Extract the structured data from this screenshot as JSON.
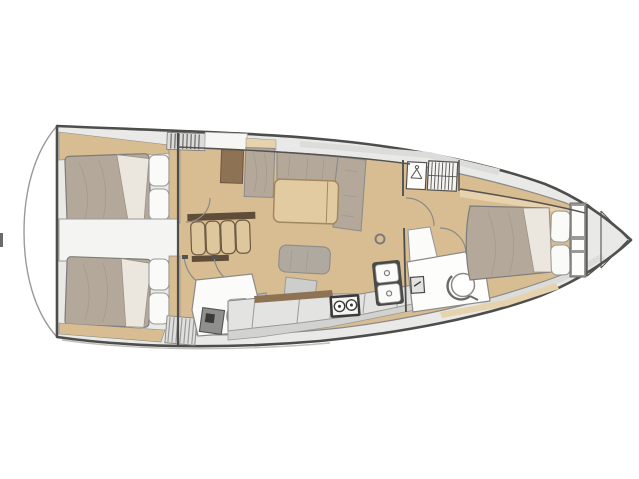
{
  "diagram": {
    "type": "sailing-yacht-interior-floor-plan",
    "orientation": "bow-right-stern-left",
    "counts": {
      "cabins": 3,
      "heads": 2,
      "companionway_steps": 4,
      "stove_burners": 2,
      "sink_basins": 2,
      "aft_cabin_pillows": 2,
      "forward_cabin_pillows": 2
    },
    "areas": [
      {
        "id": "swim-platform",
        "label": "stern swim platform"
      },
      {
        "id": "aft-cabin-port",
        "label": "aft double cabin port"
      },
      {
        "id": "aft-cabin-starboard",
        "label": "aft double cabin starboard"
      },
      {
        "id": "engine-compartment",
        "label": "engine compartment"
      },
      {
        "id": "companionway-steps",
        "label": "companionway steps"
      },
      {
        "id": "aft-head",
        "label": "aft head with toilet and shower"
      },
      {
        "id": "salon",
        "label": "salon with L-settee and table"
      },
      {
        "id": "galley",
        "label": "galley with stove and twin sinks"
      },
      {
        "id": "forward-head",
        "label": "forward head with basin"
      },
      {
        "id": "hanging-locker",
        "label": "hanging locker"
      },
      {
        "id": "louver-locker",
        "label": "louvered locker"
      },
      {
        "id": "forward-cabin",
        "label": "forward island-bed cabin"
      },
      {
        "id": "bow-locker",
        "label": "anchor bow locker"
      }
    ]
  },
  "colors": {
    "background": "#ffffff",
    "hull_outline": "#4d4d4b",
    "line_gray": "#8a8a88",
    "deck": "#e9e9e7",
    "deck_shade": "#dcdcda",
    "floor_wood": "#d9bd92",
    "wood_light": "#e6d2ac",
    "wood_dark": "#8d7254",
    "fabric_taupe": "#b4a89b",
    "fabric_fold": "#ece7de",
    "pillow_white": "#fafaf8",
    "panel_white": "#fbfbfa",
    "engine_white": "#f4f4f2",
    "furniture_gray": "#cdcdcb",
    "furniture_gray_med": "#bcbcba",
    "tray_gray": "#8f8f8d",
    "counter_gray": "#e3e3e1",
    "counter_face": "#d2d2d0",
    "stove_black": "#3a3a38",
    "sink_frame": "#4a4a48",
    "table_wood": "#e2cba0",
    "step_tread": "#dec79c",
    "step_rail": "#5f4c39",
    "grate_gray": "#e0e0de",
    "shelf_gray": "#9a9a98"
  }
}
